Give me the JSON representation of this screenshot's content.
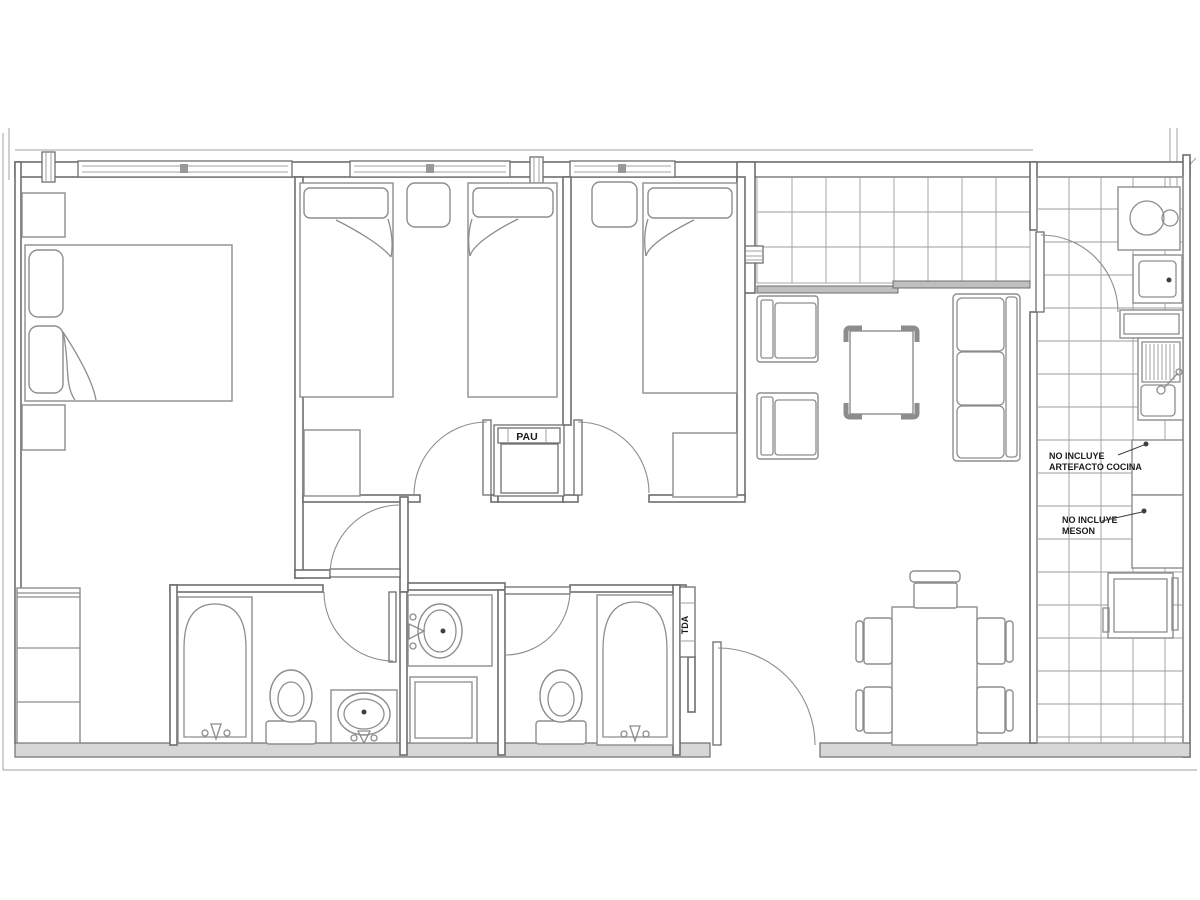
{
  "document": {
    "type": "architectural-floor-plan",
    "background": "#ffffff"
  },
  "colors": {
    "wall": "#6e6e6e",
    "furniture": "#8d8d8d",
    "grid": "#9d9d9d",
    "thin": "#a0a0a0",
    "wall_fill": "#d7d7d7",
    "text": "#1b1b1b",
    "leader": "#3f3f3f",
    "window_bar": "#999999",
    "slider_fill": "#bfbfbf"
  },
  "labels": {
    "pau": "PAU",
    "tda": "TDA",
    "kitchen_note_line1": "NO INCLUYE",
    "kitchen_note_line2": "ARTEFACTO COCINA",
    "counter_note_line1": "NO INCLUYE",
    "counter_note_line2": "MESON"
  }
}
